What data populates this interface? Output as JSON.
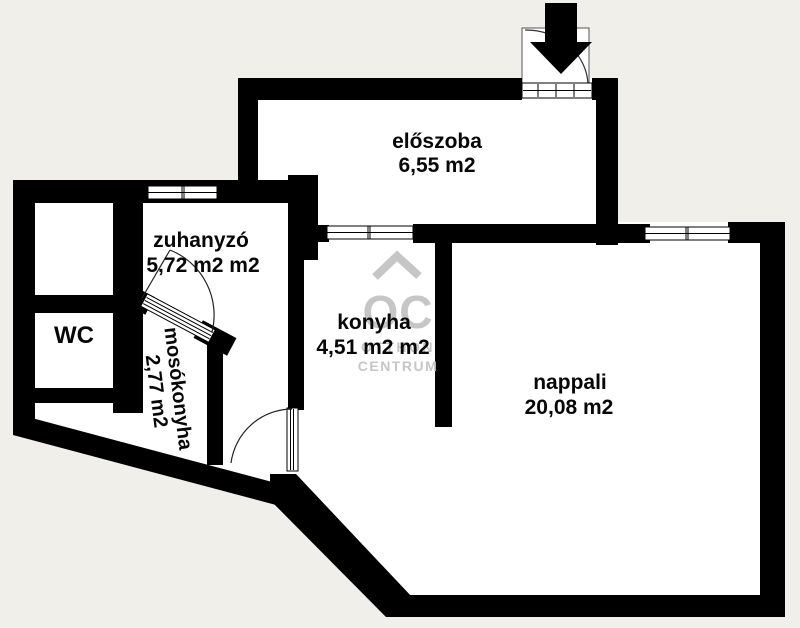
{
  "plan": {
    "rooms": {
      "eloszoba": {
        "name": "előszoba",
        "area": "6,55 m2"
      },
      "zuhanyzo": {
        "name": "zuhanyzó",
        "area": "5,72 m2 m2"
      },
      "wc": {
        "name": "WC"
      },
      "mosokonyha": {
        "name": "mosókonyha",
        "area": "2,77 m2"
      },
      "konyha": {
        "name": "konyha",
        "area": "4,51 m2 m2"
      },
      "nappali": {
        "name": "nappali",
        "area": "20,08 m2"
      }
    },
    "watermark": {
      "logo": "OC",
      "line1": "OTTHON",
      "line2": "CENTRUM"
    },
    "icons": {
      "entrance_arrow": "filled-down-arrow"
    },
    "colors": {
      "background": "#f0efea",
      "floor": "#ffffff",
      "wall": "#000000",
      "watermark": "#c6c6c6",
      "label": "#070707"
    }
  }
}
